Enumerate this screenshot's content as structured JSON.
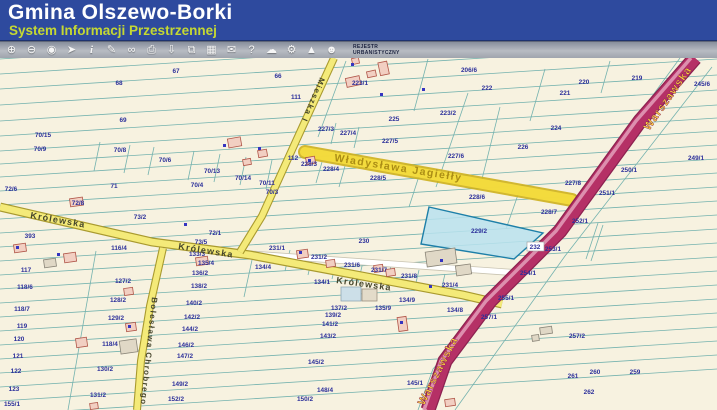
{
  "header": {
    "title": "Gmina Olszewo-Borki",
    "subtitle": "System Informacji Przestrzennej"
  },
  "toolbar": {
    "buttons": [
      {
        "name": "zoom-in",
        "glyph": "⊕"
      },
      {
        "name": "zoom-out",
        "glyph": "⊖"
      },
      {
        "name": "full-extent",
        "glyph": "◉"
      },
      {
        "name": "pointer-select",
        "glyph": "➤"
      },
      {
        "name": "identify",
        "glyph": "i"
      },
      {
        "name": "draw-measure",
        "glyph": "✎"
      },
      {
        "name": "link",
        "glyph": "∞"
      },
      {
        "name": "print",
        "glyph": "⎙"
      },
      {
        "name": "download",
        "glyph": "⇩"
      },
      {
        "name": "copy-view",
        "glyph": "⧉"
      },
      {
        "name": "layout-grid",
        "glyph": "▦"
      },
      {
        "name": "comment",
        "glyph": "✉"
      },
      {
        "name": "help",
        "glyph": "?"
      },
      {
        "name": "cloud-export",
        "glyph": "☁"
      },
      {
        "name": "settings",
        "glyph": "⚙"
      },
      {
        "name": "north-arrow",
        "glyph": "▲"
      },
      {
        "name": "share-contact",
        "glyph": "☻"
      }
    ],
    "rejestr": {
      "line1": "REJESTR",
      "line2": "URBANISTYCZNY"
    }
  },
  "map": {
    "colors": {
      "background": "#f7f2e0",
      "parcel_line": "#74b2ae",
      "parcel_label": "#2b2f9a",
      "road_yellow": "#f4ea79",
      "road_main_red": "#b53066",
      "highlight_yellow": "#f4dc3e",
      "selected_parcel_fill": "#b8e2ef",
      "selected_parcel_border": "#1d7fa8"
    },
    "selected_parcel": "229/2",
    "boxed_label": {
      "text": "232"
    },
    "road_labels": [
      {
        "text": "Królewska",
        "x": 30,
        "y": 217,
        "rotate": 10,
        "cls": "street"
      },
      {
        "text": "Królewska",
        "x": 178,
        "y": 248,
        "rotate": 9,
        "cls": "street"
      },
      {
        "text": "Królewska",
        "x": 336,
        "y": 282,
        "rotate": 8,
        "cls": "street"
      },
      {
        "text": "Mieszka I",
        "x": 320,
        "y": 76,
        "rotate": 113,
        "cls": "street-sm"
      },
      {
        "text": "Bolesława Chrobrego",
        "x": 152,
        "y": 296,
        "rotate": 96,
        "cls": "street-sm"
      },
      {
        "text": "Warszawska",
        "x": 649,
        "y": 130,
        "rotate": -55,
        "cls": "warszawska"
      },
      {
        "text": "Warszawska",
        "x": 424,
        "y": 405,
        "rotate": -63,
        "cls": "warszawska"
      },
      {
        "text": "Władysława Jagiełły",
        "x": 334,
        "y": 160,
        "rotate": 9,
        "cls": "jagielly"
      }
    ],
    "parcels": [
      {
        "t": "67",
        "x": 176,
        "y": 72
      },
      {
        "t": "68",
        "x": 119,
        "y": 84
      },
      {
        "t": "66",
        "x": 278,
        "y": 77
      },
      {
        "t": "69",
        "x": 123,
        "y": 121
      },
      {
        "t": "111",
        "x": 296,
        "y": 98
      },
      {
        "t": "70/15",
        "x": 43,
        "y": 136
      },
      {
        "t": "70/9",
        "x": 40,
        "y": 150
      },
      {
        "t": "70/8",
        "x": 120,
        "y": 151
      },
      {
        "t": "70/6",
        "x": 165,
        "y": 161
      },
      {
        "t": "70/13",
        "x": 212,
        "y": 172
      },
      {
        "t": "70/14",
        "x": 243,
        "y": 179
      },
      {
        "t": "70/11",
        "x": 267,
        "y": 184
      },
      {
        "t": "70/3",
        "x": 272,
        "y": 193
      },
      {
        "t": "70/4",
        "x": 197,
        "y": 186
      },
      {
        "t": "112",
        "x": 293,
        "y": 159
      },
      {
        "t": "223/1",
        "x": 360,
        "y": 84
      },
      {
        "t": "206/6",
        "x": 469,
        "y": 71
      },
      {
        "t": "222",
        "x": 487,
        "y": 89
      },
      {
        "t": "225",
        "x": 394,
        "y": 120
      },
      {
        "t": "223/2",
        "x": 448,
        "y": 114
      },
      {
        "t": "221",
        "x": 565,
        "y": 94
      },
      {
        "t": "220",
        "x": 584,
        "y": 83
      },
      {
        "t": "219",
        "x": 637,
        "y": 79
      },
      {
        "t": "245/6",
        "x": 702,
        "y": 85
      },
      {
        "t": "224",
        "x": 556,
        "y": 129
      },
      {
        "t": "226",
        "x": 523,
        "y": 148
      },
      {
        "t": "227/3",
        "x": 326,
        "y": 130
      },
      {
        "t": "227/4",
        "x": 348,
        "y": 134
      },
      {
        "t": "227/5",
        "x": 390,
        "y": 142
      },
      {
        "t": "227/6",
        "x": 456,
        "y": 157
      },
      {
        "t": "227/8",
        "x": 573,
        "y": 184
      },
      {
        "t": "228/3",
        "x": 309,
        "y": 165
      },
      {
        "t": "228/4",
        "x": 331,
        "y": 170
      },
      {
        "t": "228/5",
        "x": 378,
        "y": 179
      },
      {
        "t": "228/6",
        "x": 477,
        "y": 198
      },
      {
        "t": "228/7",
        "x": 549,
        "y": 213
      },
      {
        "t": "229/2",
        "x": 479,
        "y": 232
      },
      {
        "t": "230",
        "x": 364,
        "y": 242
      },
      {
        "t": "231/1",
        "x": 277,
        "y": 249
      },
      {
        "t": "231/2",
        "x": 319,
        "y": 258
      },
      {
        "t": "231/6",
        "x": 352,
        "y": 266
      },
      {
        "t": "231/7",
        "x": 379,
        "y": 271
      },
      {
        "t": "231/8",
        "x": 409,
        "y": 277
      },
      {
        "t": "231/4",
        "x": 450,
        "y": 286
      },
      {
        "t": "134/4",
        "x": 263,
        "y": 268
      },
      {
        "t": "134/1",
        "x": 322,
        "y": 283
      },
      {
        "t": "134/9",
        "x": 407,
        "y": 301
      },
      {
        "t": "134/8",
        "x": 455,
        "y": 311
      },
      {
        "t": "135/9",
        "x": 383,
        "y": 309
      },
      {
        "t": "137/2",
        "x": 339,
        "y": 309
      },
      {
        "t": "139/2",
        "x": 333,
        "y": 316
      },
      {
        "t": "141/2",
        "x": 330,
        "y": 325
      },
      {
        "t": "143/2",
        "x": 328,
        "y": 337
      },
      {
        "t": "145/2",
        "x": 316,
        "y": 363
      },
      {
        "t": "145/1",
        "x": 415,
        "y": 384
      },
      {
        "t": "148/4",
        "x": 325,
        "y": 391
      },
      {
        "t": "150/2",
        "x": 305,
        "y": 400
      },
      {
        "t": "72/6",
        "x": 11,
        "y": 190
      },
      {
        "t": "71",
        "x": 114,
        "y": 187
      },
      {
        "t": "72/8",
        "x": 78,
        "y": 204
      },
      {
        "t": "73/2",
        "x": 140,
        "y": 218
      },
      {
        "t": "72/1",
        "x": 215,
        "y": 234
      },
      {
        "t": "73/5",
        "x": 201,
        "y": 243
      },
      {
        "t": "393",
        "x": 30,
        "y": 237
      },
      {
        "t": "116/4",
        "x": 119,
        "y": 249
      },
      {
        "t": "133/3",
        "x": 197,
        "y": 255
      },
      {
        "t": "135/4",
        "x": 206,
        "y": 264
      },
      {
        "t": "136/2",
        "x": 200,
        "y": 274
      },
      {
        "t": "138/2",
        "x": 199,
        "y": 287
      },
      {
        "t": "117",
        "x": 26,
        "y": 271
      },
      {
        "t": "118/6",
        "x": 25,
        "y": 288
      },
      {
        "t": "118/7",
        "x": 22,
        "y": 310
      },
      {
        "t": "119",
        "x": 22,
        "y": 327
      },
      {
        "t": "120",
        "x": 19,
        "y": 340
      },
      {
        "t": "121",
        "x": 18,
        "y": 357
      },
      {
        "t": "122",
        "x": 16,
        "y": 372
      },
      {
        "t": "123",
        "x": 14,
        "y": 390
      },
      {
        "t": "155/1",
        "x": 12,
        "y": 405
      },
      {
        "t": "127/2",
        "x": 123,
        "y": 282
      },
      {
        "t": "128/2",
        "x": 118,
        "y": 301
      },
      {
        "t": "129/2",
        "x": 116,
        "y": 319
      },
      {
        "t": "118/4",
        "x": 110,
        "y": 345
      },
      {
        "t": "130/2",
        "x": 105,
        "y": 370
      },
      {
        "t": "131/2",
        "x": 98,
        "y": 396
      },
      {
        "t": "140/2",
        "x": 194,
        "y": 304
      },
      {
        "t": "142/2",
        "x": 192,
        "y": 318
      },
      {
        "t": "144/2",
        "x": 190,
        "y": 330
      },
      {
        "t": "146/2",
        "x": 186,
        "y": 346
      },
      {
        "t": "147/2",
        "x": 185,
        "y": 357
      },
      {
        "t": "149/2",
        "x": 180,
        "y": 385
      },
      {
        "t": "152/2",
        "x": 176,
        "y": 400
      },
      {
        "t": "249/1",
        "x": 696,
        "y": 159
      },
      {
        "t": "250/1",
        "x": 629,
        "y": 171
      },
      {
        "t": "251/1",
        "x": 607,
        "y": 194
      },
      {
        "t": "252/1",
        "x": 580,
        "y": 222
      },
      {
        "t": "253/1",
        "x": 553,
        "y": 250
      },
      {
        "t": "254/1",
        "x": 528,
        "y": 274
      },
      {
        "t": "255/1",
        "x": 506,
        "y": 299
      },
      {
        "t": "257/1",
        "x": 489,
        "y": 318
      },
      {
        "t": "257/2",
        "x": 577,
        "y": 337
      },
      {
        "t": "260",
        "x": 595,
        "y": 373
      },
      {
        "t": "259",
        "x": 635,
        "y": 373
      },
      {
        "t": "261",
        "x": 573,
        "y": 377
      },
      {
        "t": "262",
        "x": 589,
        "y": 393
      }
    ]
  }
}
